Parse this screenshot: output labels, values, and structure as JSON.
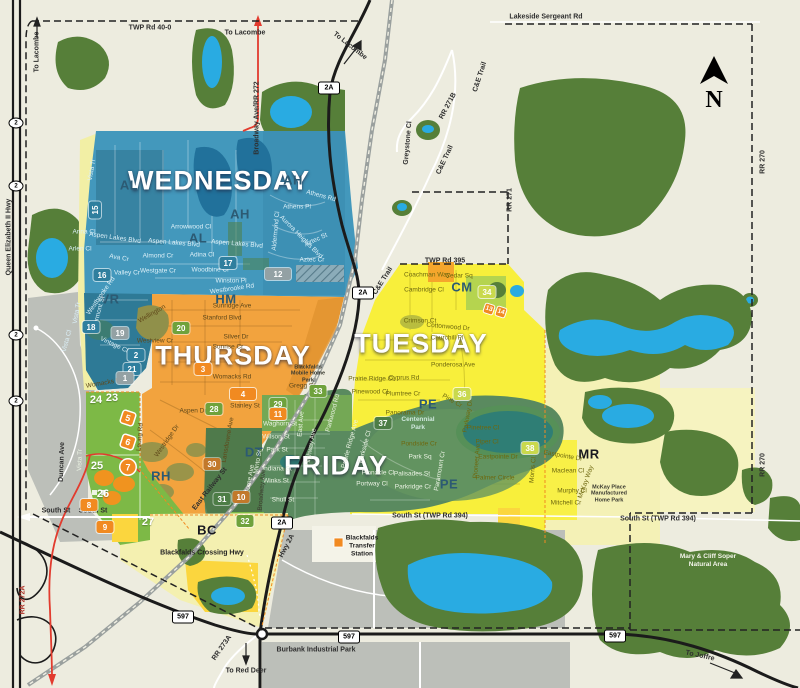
{
  "map": {
    "compass_letter": "N",
    "colors": {
      "background": "#edecdf",
      "wednesday_blue": "#4398bc",
      "thursday_orange": "#f2a33e",
      "tuesday_yellow": "#f8ef3b",
      "friday_green": "#5a8a5f",
      "pale_yellow": "#f4f1b6",
      "lime_green": "#7db946",
      "forest_green": "#567f39",
      "water_blue": "#29abe2",
      "industrial_gray": "#bcbfb9",
      "marker_orange": "#f18a21",
      "boundary_red": "#e23b2e"
    },
    "day_labels": [
      {
        "t": "WEDNESDAY",
        "x": 219,
        "y": 181
      },
      {
        "t": "THURSDAY",
        "x": 233,
        "y": 356
      },
      {
        "t": "TUESDAY",
        "x": 421,
        "y": 344
      },
      {
        "t": "FRIDAY",
        "x": 336,
        "y": 466
      }
    ],
    "area_codes": [
      {
        "t": "AH",
        "x": 293,
        "y": 180
      },
      {
        "t": "AL",
        "x": 129,
        "y": 185
      },
      {
        "t": "AH",
        "x": 240,
        "y": 214
      },
      {
        "t": "AL",
        "x": 198,
        "y": 238
      },
      {
        "t": "VR",
        "x": 110,
        "y": 299
      },
      {
        "t": "HM",
        "x": 226,
        "y": 299
      },
      {
        "t": "CM",
        "x": 462,
        "y": 287
      },
      {
        "t": "PE",
        "x": 428,
        "y": 404
      },
      {
        "t": "PE",
        "x": 449,
        "y": 484
      },
      {
        "t": "DT",
        "x": 254,
        "y": 452
      },
      {
        "t": "RH",
        "x": 161,
        "y": 476
      },
      {
        "t": "BC",
        "x": 207,
        "y": 530,
        "c": "codeD"
      },
      {
        "t": "MR",
        "x": 589,
        "y": 454,
        "c": "codeD"
      }
    ],
    "zone_badges": [
      {
        "n": "15",
        "x": 95,
        "y": 210,
        "k": "k-teal",
        "r": -90
      },
      {
        "n": "16",
        "x": 102,
        "y": 275,
        "k": "k-teal"
      },
      {
        "n": "17",
        "x": 228,
        "y": 263,
        "k": "k-teal"
      },
      {
        "n": "18",
        "x": 91,
        "y": 327,
        "k": "k-teal"
      },
      {
        "n": "2",
        "x": 136,
        "y": 355,
        "k": "k-teal"
      },
      {
        "n": "21",
        "x": 132,
        "y": 369,
        "k": "k-teal"
      },
      {
        "n": "1",
        "x": 125,
        "y": 378,
        "k": "k-gray"
      },
      {
        "n": "19",
        "x": 120,
        "y": 333,
        "k": "k-gray"
      },
      {
        "n": "12",
        "x": 278,
        "y": 274,
        "k": "k-gray",
        "w": 26
      },
      {
        "n": "20",
        "x": 181,
        "y": 328,
        "k": "k-green"
      },
      {
        "n": "28",
        "x": 214,
        "y": 409,
        "k": "k-green"
      },
      {
        "n": "29",
        "x": 278,
        "y": 404,
        "k": "k-green"
      },
      {
        "n": "33",
        "x": 318,
        "y": 391,
        "k": "k-green"
      },
      {
        "n": "32",
        "x": 245,
        "y": 521,
        "k": "k-green"
      },
      {
        "n": "31",
        "x": 222,
        "y": 499,
        "k": "k-dgreen"
      },
      {
        "n": "37",
        "x": 383,
        "y": 423,
        "k": "k-dgreen"
      },
      {
        "n": "34",
        "x": 487,
        "y": 292,
        "k": "k-ygreen"
      },
      {
        "n": "36",
        "x": 462,
        "y": 394,
        "k": "k-ygreen"
      },
      {
        "n": "38",
        "x": 530,
        "y": 448,
        "k": "k-ygreen"
      },
      {
        "n": "3",
        "x": 203,
        "y": 369,
        "k": "k-orange"
      },
      {
        "n": "4",
        "x": 243,
        "y": 394,
        "k": "k-orange",
        "w": 26
      },
      {
        "n": "8",
        "x": 89,
        "y": 505,
        "k": "k-orange"
      },
      {
        "n": "9",
        "x": 105,
        "y": 527,
        "k": "k-orange"
      },
      {
        "n": "11",
        "x": 278,
        "y": 414,
        "k": "k-orange"
      },
      {
        "n": "30",
        "x": 212,
        "y": 464,
        "k": "k-dorange"
      },
      {
        "n": "10",
        "x": 241,
        "y": 497,
        "k": "k-dorange"
      },
      {
        "n": "7",
        "x": 128,
        "y": 467,
        "k": "k-circle"
      },
      {
        "n": "5",
        "x": 128,
        "y": 418,
        "k": "k-diamond",
        "r": 18
      },
      {
        "n": "6",
        "x": 128,
        "y": 442,
        "k": "k-diamond",
        "r": 18
      },
      {
        "n": "13",
        "x": 489,
        "y": 309,
        "k": "k-diamond-sm",
        "r": 18
      },
      {
        "n": "14",
        "x": 501,
        "y": 312,
        "k": "k-diamond-sm",
        "r": 18
      },
      {
        "n": "23",
        "x": 112,
        "y": 398,
        "k": "k-plain"
      },
      {
        "n": "24",
        "x": 96,
        "y": 400,
        "k": "k-plain"
      },
      {
        "n": "25",
        "x": 97,
        "y": 466,
        "k": "k-plain"
      },
      {
        "n": "26",
        "x": 103,
        "y": 494,
        "k": "k-plain"
      },
      {
        "n": "27",
        "x": 148,
        "y": 522,
        "k": "k-plain"
      }
    ],
    "road_shields": [
      {
        "t": "2A",
        "x": 329,
        "y": 88,
        "s": "sh-r"
      },
      {
        "t": "2A",
        "x": 363,
        "y": 293,
        "s": "sh-r"
      },
      {
        "t": "2A",
        "x": 282,
        "y": 523,
        "s": "sh-r"
      },
      {
        "t": "597",
        "x": 183,
        "y": 617,
        "s": "sh-r"
      },
      {
        "t": "597",
        "x": 349,
        "y": 637,
        "s": "sh-r"
      },
      {
        "t": "597",
        "x": 615,
        "y": 636,
        "s": "sh-r"
      },
      {
        "t": "2",
        "x": 16,
        "y": 123,
        "s": "sh-o"
      },
      {
        "t": "2",
        "x": 16,
        "y": 186,
        "s": "sh-o"
      },
      {
        "t": "2",
        "x": 16,
        "y": 335,
        "s": "sh-o"
      },
      {
        "t": "2",
        "x": 16,
        "y": 401,
        "s": "sh-o"
      }
    ],
    "road_labels": [
      {
        "t": "TWP Rd 40-0",
        "x": 150,
        "y": 28
      },
      {
        "t": "Lakeside Sergeant Rd",
        "x": 546,
        "y": 17
      },
      {
        "t": "To Lacombe",
        "x": 37,
        "y": 52,
        "r": -90
      },
      {
        "t": "To Lacombe",
        "x": 245,
        "y": 33
      },
      {
        "t": "To Lacombe",
        "x": 350,
        "y": 46,
        "r": 38
      },
      {
        "t": "TWP Rd 395",
        "x": 445,
        "y": 261
      },
      {
        "t": "South St",
        "x": 56,
        "y": 511
      },
      {
        "t": "South St",
        "x": 93,
        "y": 511
      },
      {
        "t": "South St (TWP Rd 394)",
        "x": 430,
        "y": 516
      },
      {
        "t": "South St (TWP Rd 394)",
        "x": 658,
        "y": 519
      },
      {
        "t": "C&E Trail",
        "x": 480,
        "y": 77,
        "r": -72
      },
      {
        "t": "C&E Trail",
        "x": 445,
        "y": 160,
        "r": -65
      },
      {
        "t": "C&E Trail",
        "x": 383,
        "y": 281,
        "r": -58
      },
      {
        "t": "RR 271B",
        "x": 448,
        "y": 106,
        "r": -62
      },
      {
        "t": "Greystone Cl",
        "x": 408,
        "y": 143,
        "r": -85
      },
      {
        "t": "RR 271",
        "x": 510,
        "y": 200,
        "r": -90
      },
      {
        "t": "RR 270",
        "x": 763,
        "y": 162,
        "r": -90
      },
      {
        "t": "RR 270",
        "x": 763,
        "y": 465,
        "r": -90
      },
      {
        "t": "RR 272A",
        "x": 23,
        "y": 600,
        "r": -90,
        "c": "rdR"
      },
      {
        "t": "RR 273A",
        "x": 222,
        "y": 648,
        "r": -55
      },
      {
        "t": "To Red Deer",
        "x": 246,
        "y": 671
      },
      {
        "t": "To Joffre",
        "x": 700,
        "y": 656,
        "r": 12
      },
      {
        "t": "Queen Elizabeth II Hwy",
        "x": 9,
        "y": 237,
        "r": -90
      },
      {
        "t": "Broadway Ave/RR 272",
        "x": 257,
        "y": 118,
        "r": -90
      },
      {
        "t": "Burbank Industrial Park",
        "x": 316,
        "y": 650
      },
      {
        "t": "Hwy 2A",
        "x": 287,
        "y": 546,
        "r": -62
      },
      {
        "t": "Duncan Ave",
        "x": 62,
        "y": 462,
        "r": -88
      },
      {
        "t": "East Railway St",
        "x": 210,
        "y": 489,
        "r": -52
      }
    ],
    "street_labels": [
      {
        "t": "Vista Tr",
        "x": 92,
        "y": 170,
        "r": -80,
        "c": "stB"
      },
      {
        "t": "Anna Cl",
        "x": 84,
        "y": 232,
        "c": "stB"
      },
      {
        "t": "Aspen Lakes Blvd",
        "x": 115,
        "y": 238,
        "r": 8,
        "c": "stB"
      },
      {
        "t": "Arlen Cl",
        "x": 80,
        "y": 249,
        "c": "stB"
      },
      {
        "t": "Ava Cr",
        "x": 119,
        "y": 258,
        "r": 10,
        "c": "stB"
      },
      {
        "t": "Valley Cr",
        "x": 127,
        "y": 273,
        "c": "stB"
      },
      {
        "t": "Almond Cr",
        "x": 158,
        "y": 256,
        "c": "stB"
      },
      {
        "t": "Adina Cl",
        "x": 202,
        "y": 255,
        "c": "stB"
      },
      {
        "t": "Westgate Cr",
        "x": 158,
        "y": 271,
        "c": "stB"
      },
      {
        "t": "Woodbine Cl",
        "x": 210,
        "y": 270,
        "c": "stB"
      },
      {
        "t": "Winston Pl",
        "x": 231,
        "y": 281,
        "c": "stB"
      },
      {
        "t": "Westbrooke Rd",
        "x": 232,
        "y": 289,
        "r": -8,
        "c": "stB"
      },
      {
        "t": "Westbrooke Rd",
        "x": 101,
        "y": 296,
        "r": -55,
        "c": "stB"
      },
      {
        "t": "Vermont St",
        "x": 99,
        "y": 312,
        "r": -75,
        "c": "stB"
      },
      {
        "t": "Vista Tr",
        "x": 77,
        "y": 313,
        "r": -80,
        "c": "stB"
      },
      {
        "t": "Vista Cl",
        "x": 67,
        "y": 341,
        "r": -75,
        "c": "stB"
      },
      {
        "t": "Vintage Cl",
        "x": 114,
        "y": 345,
        "r": 25,
        "c": "stB"
      },
      {
        "t": "Arrowwood Cl",
        "x": 191,
        "y": 227,
        "c": "stB"
      },
      {
        "t": "Aspen Lakes Blvd",
        "x": 174,
        "y": 243,
        "r": 5,
        "c": "stB"
      },
      {
        "t": "Aspen Lakes Blvd",
        "x": 237,
        "y": 244,
        "r": 5,
        "c": "stB"
      },
      {
        "t": "Athens Rd",
        "x": 321,
        "y": 196,
        "r": 15,
        "c": "stB"
      },
      {
        "t": "Athens Pl",
        "x": 297,
        "y": 207,
        "c": "stB"
      },
      {
        "t": "Aurora Heights Blvd",
        "x": 301,
        "y": 237,
        "r": 45,
        "c": "stB"
      },
      {
        "t": "Aztec St",
        "x": 316,
        "y": 240,
        "r": -25,
        "c": "stB"
      },
      {
        "t": "Aztec Cr",
        "x": 312,
        "y": 260,
        "c": "stB"
      },
      {
        "t": "Aldermond Cl",
        "x": 276,
        "y": 231,
        "r": -85,
        "c": "stB"
      },
      {
        "t": "Wellington",
        "x": 152,
        "y": 314,
        "r": -30,
        "c": "stO"
      },
      {
        "t": "Sunridge Ave",
        "x": 232,
        "y": 306,
        "c": "stO"
      },
      {
        "t": "Stanford Blvd",
        "x": 222,
        "y": 318,
        "c": "stO"
      },
      {
        "t": "Silver Dr",
        "x": 236,
        "y": 337,
        "c": "stO"
      },
      {
        "t": "Sunrise Cr",
        "x": 228,
        "y": 347,
        "c": "stO"
      },
      {
        "t": "Westview Cr",
        "x": 155,
        "y": 341,
        "c": "stO"
      },
      {
        "t": "Womacks Rd",
        "x": 105,
        "y": 383,
        "r": -10,
        "c": "stO"
      },
      {
        "t": "Womacks Rd",
        "x": 232,
        "y": 377,
        "c": "stO"
      },
      {
        "t": "Gregg St",
        "x": 302,
        "y": 386,
        "c": "stO"
      },
      {
        "t": "Stanley St",
        "x": 245,
        "y": 406,
        "c": "stO"
      },
      {
        "t": "Aspen Dr",
        "x": 193,
        "y": 411,
        "c": "stO"
      },
      {
        "t": "Lansdowne Ave",
        "x": 228,
        "y": 440,
        "r": -80,
        "c": "stO"
      },
      {
        "t": "Leung Rd",
        "x": 140,
        "y": 437,
        "r": -85,
        "c": "stO"
      },
      {
        "t": "Westridge Dr",
        "x": 167,
        "y": 441,
        "r": -55,
        "c": "stO"
      },
      {
        "t": "Coachman Way",
        "x": 427,
        "y": 275,
        "c": "stY"
      },
      {
        "t": "Cedar Sq",
        "x": 459,
        "y": 276,
        "c": "stY"
      },
      {
        "t": "Cambridge Cl",
        "x": 424,
        "y": 290,
        "c": "stY"
      },
      {
        "t": "Crimson Ct",
        "x": 420,
        "y": 321,
        "c": "stY"
      },
      {
        "t": "Cottonwood Dr",
        "x": 448,
        "y": 327,
        "r": 5,
        "c": "stY"
      },
      {
        "t": "Churchill Pl",
        "x": 447,
        "y": 338,
        "c": "stY"
      },
      {
        "t": "Ponderosa Ave",
        "x": 453,
        "y": 365,
        "c": "stY"
      },
      {
        "t": "Cyprus Rd",
        "x": 404,
        "y": 378,
        "c": "stY"
      },
      {
        "t": "Prairie Ridge Cl",
        "x": 371,
        "y": 379,
        "c": "stY"
      },
      {
        "t": "Pinewood Cl",
        "x": 370,
        "y": 392,
        "c": "stY"
      },
      {
        "t": "Plumtree Cr",
        "x": 403,
        "y": 394,
        "c": "stY"
      },
      {
        "t": "Panorama Dr",
        "x": 405,
        "y": 413,
        "c": "stY"
      },
      {
        "t": "Pine Cr",
        "x": 452,
        "y": 401,
        "r": 30,
        "c": "stY"
      },
      {
        "t": "Pinetree Cl",
        "x": 483,
        "y": 428,
        "c": "stY"
      },
      {
        "t": "Piper Cl",
        "x": 487,
        "y": 442,
        "c": "stY"
      },
      {
        "t": "Pioneer Ave",
        "x": 477,
        "y": 461,
        "r": -85,
        "c": "stY"
      },
      {
        "t": "Eastpointe Dr",
        "x": 498,
        "y": 457,
        "c": "stY"
      },
      {
        "t": "Palmer Circle",
        "x": 495,
        "y": 478,
        "c": "stY"
      },
      {
        "t": "Morris Cl",
        "x": 533,
        "y": 470,
        "r": -85,
        "c": "stY"
      },
      {
        "t": "Parkway Dr",
        "x": 468,
        "y": 416,
        "r": -80,
        "c": "stY"
      },
      {
        "t": "Eastpointe Dr",
        "x": 563,
        "y": 456,
        "r": 10,
        "c": "stY"
      },
      {
        "t": "Maclean Cl",
        "x": 568,
        "y": 471,
        "c": "stY"
      },
      {
        "t": "Murphy Cl",
        "x": 572,
        "y": 491,
        "c": "stY"
      },
      {
        "t": "Mitchell Cr",
        "x": 566,
        "y": 503,
        "c": "stY"
      },
      {
        "t": "McKay Way",
        "x": 586,
        "y": 482,
        "r": -70,
        "c": "stY"
      },
      {
        "t": "Pondside Cr",
        "x": 419,
        "y": 444,
        "c": "stY"
      },
      {
        "t": "Waghorn St",
        "x": 280,
        "y": 424,
        "c": "stG"
      },
      {
        "t": "Wilson St",
        "x": 276,
        "y": 437,
        "c": "stG"
      },
      {
        "t": "Park St",
        "x": 277,
        "y": 450,
        "c": "stG"
      },
      {
        "t": "Indiana St",
        "x": 277,
        "y": 469,
        "c": "stG"
      },
      {
        "t": "Winks St",
        "x": 276,
        "y": 481,
        "c": "stG"
      },
      {
        "t": "Shull St",
        "x": 283,
        "y": 500,
        "c": "stG"
      },
      {
        "t": "East Ave",
        "x": 301,
        "y": 424,
        "r": -85,
        "c": "stG"
      },
      {
        "t": "Highway Ave",
        "x": 311,
        "y": 447,
        "r": -80,
        "c": "stG"
      },
      {
        "t": "Minto St",
        "x": 258,
        "y": 462,
        "r": -80,
        "c": "stG"
      },
      {
        "t": "Lorne Ave",
        "x": 250,
        "y": 479,
        "r": -80,
        "c": "stG"
      },
      {
        "t": "Parkwood Rd",
        "x": 333,
        "y": 413,
        "r": -75,
        "c": "stG"
      },
      {
        "t": "Park Sq",
        "x": 420,
        "y": 457,
        "c": "stG"
      },
      {
        "t": "Palisades St",
        "x": 412,
        "y": 474,
        "c": "stG"
      },
      {
        "t": "Parkridge Cr",
        "x": 413,
        "y": 487,
        "c": "stG"
      },
      {
        "t": "Paramount Cr",
        "x": 440,
        "y": 471,
        "r": -80,
        "c": "stG"
      },
      {
        "t": "Pinnacle Cl",
        "x": 378,
        "y": 473,
        "c": "stG"
      },
      {
        "t": "Portway Cl",
        "x": 372,
        "y": 484,
        "c": "stG"
      },
      {
        "t": "Parkside Cl",
        "x": 365,
        "y": 447,
        "r": -75,
        "c": "stG"
      },
      {
        "t": "Prairie Ridge Ave",
        "x": 350,
        "y": 444,
        "r": -75,
        "c": "stG"
      },
      {
        "t": "Broadway Ave",
        "x": 262,
        "y": 490,
        "r": -85,
        "c": "stD"
      },
      {
        "t": "Vista Tr",
        "x": 80,
        "y": 460,
        "r": -88,
        "c": "stG"
      }
    ],
    "poi_labels": [
      {
        "t": "Blackfalds Transfer Station",
        "x": 362,
        "y": 546,
        "c": "poi"
      },
      {
        "t": "Mary & Cliff Soper Natural Area",
        "x": 708,
        "y": 561,
        "c": "poiW"
      },
      {
        "t": "Centennial Park",
        "x": 418,
        "y": 424,
        "c": "poiT"
      },
      {
        "t": "Blackfalds Mobile Home Park",
        "x": 308,
        "y": 374,
        "c": "poiS"
      },
      {
        "t": "McKay Place Manufactured Home Park",
        "x": 609,
        "y": 494,
        "c": "poiS"
      },
      {
        "t": "Blackfalds Crossing Hwy",
        "x": 202,
        "y": 553,
        "c": "poiB"
      }
    ]
  }
}
